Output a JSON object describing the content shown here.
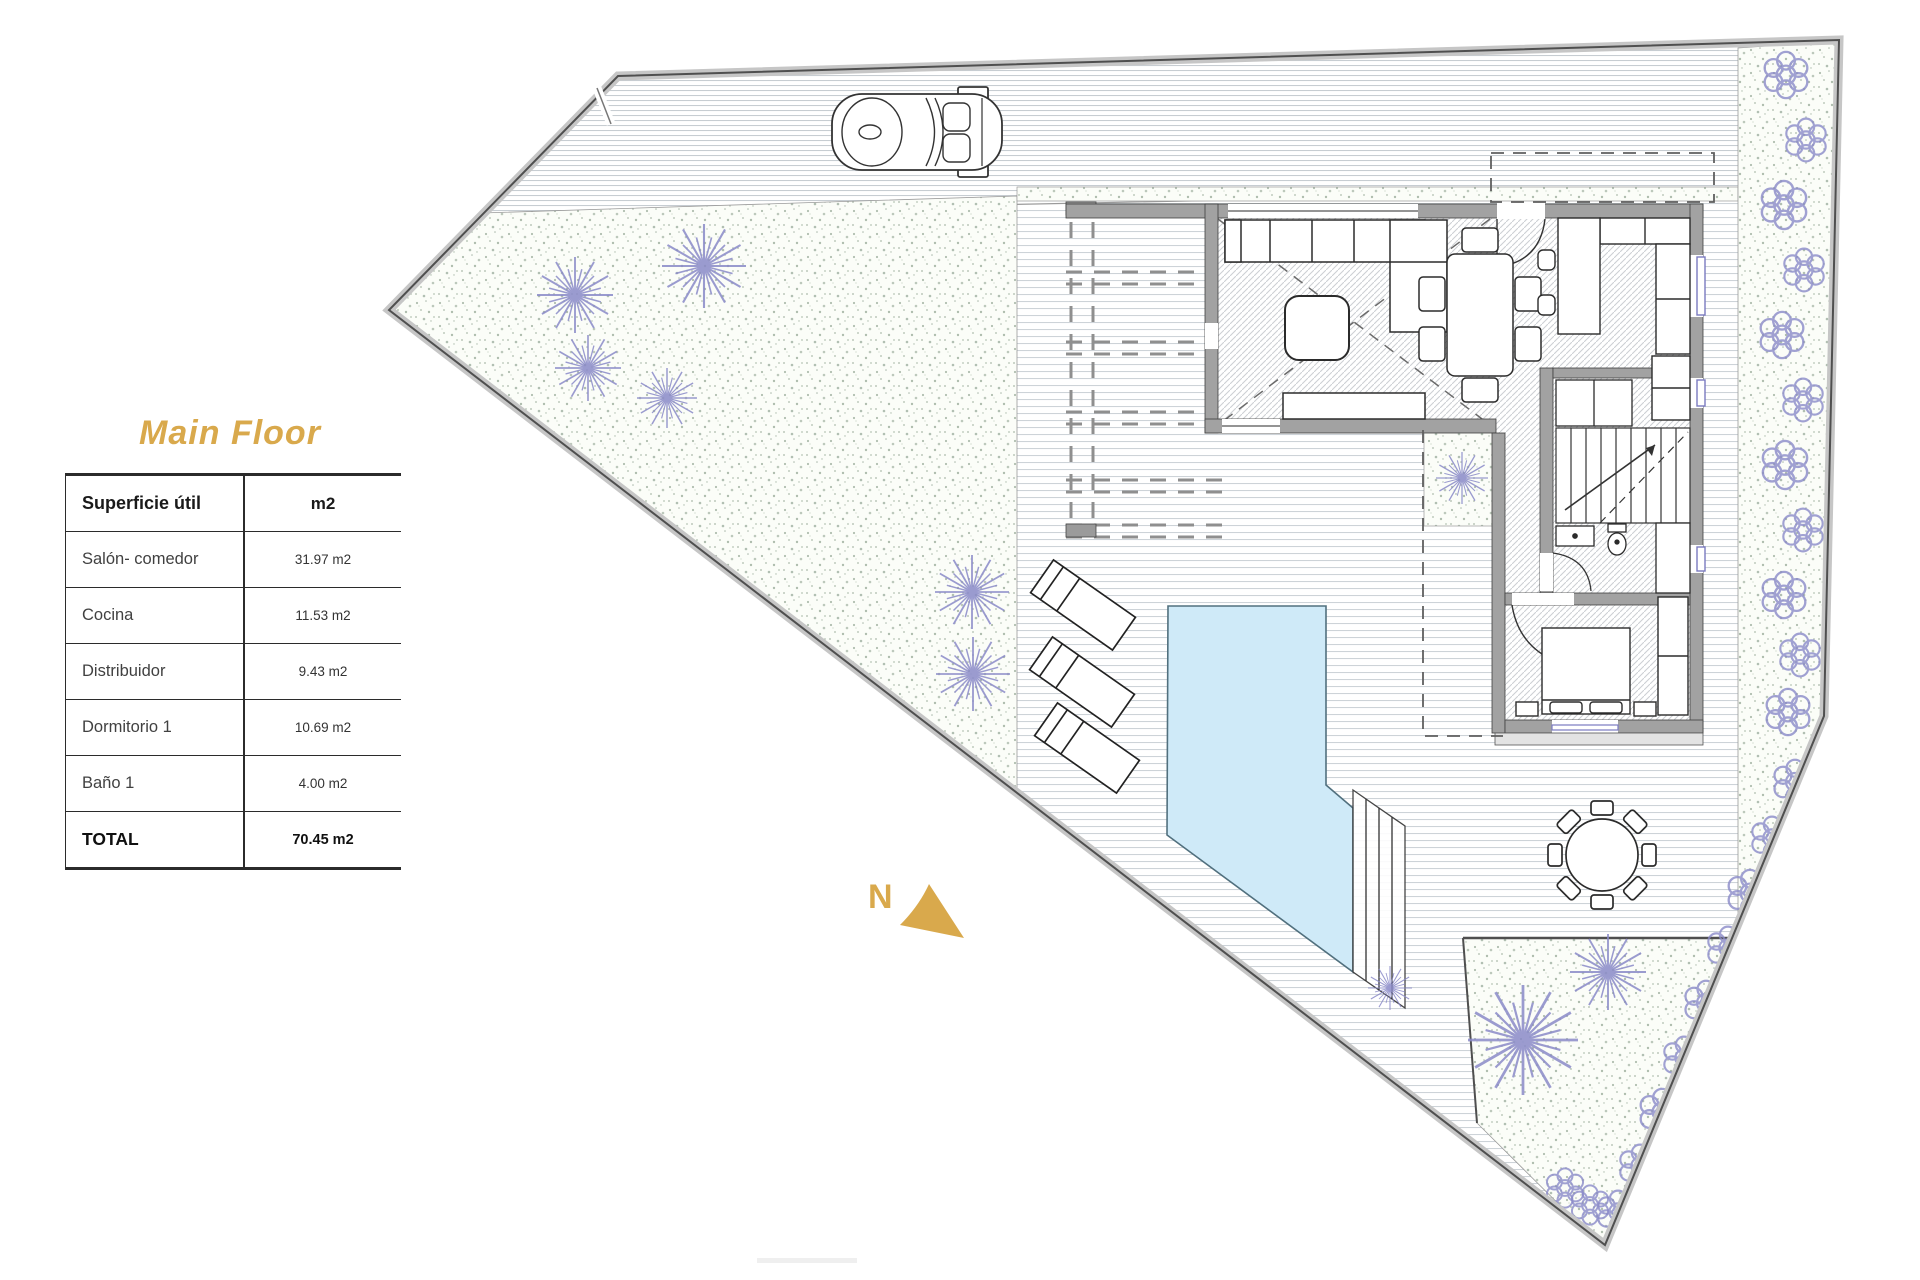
{
  "title": {
    "text": "Main Floor"
  },
  "area_table": {
    "header": {
      "label": "Superficie útil",
      "unit": "m2"
    },
    "rows": [
      {
        "label": "Salón- comedor",
        "value": "31.97 m2"
      },
      {
        "label": "Cocina",
        "value": "11.53 m2"
      },
      {
        "label": "Distribuidor",
        "value": "9.43 m2"
      },
      {
        "label": "Dormitorio 1",
        "value": "10.69 m2"
      },
      {
        "label": "Baño 1",
        "value": "4.00 m2"
      }
    ],
    "total": {
      "label": "TOTAL",
      "value": "70.45 m2"
    }
  },
  "compass": {
    "label": "N"
  },
  "colors": {
    "accent_gold": "#D9A94C",
    "pool_blue": "#CFEAF8",
    "wall_gray": "#A2A2A2",
    "stripe_gray": "#CDD3D8",
    "vegetation_blue": "#8A8AC8",
    "stipple_green": "#7D937D",
    "boundary_gray": "#C6C6C6"
  }
}
